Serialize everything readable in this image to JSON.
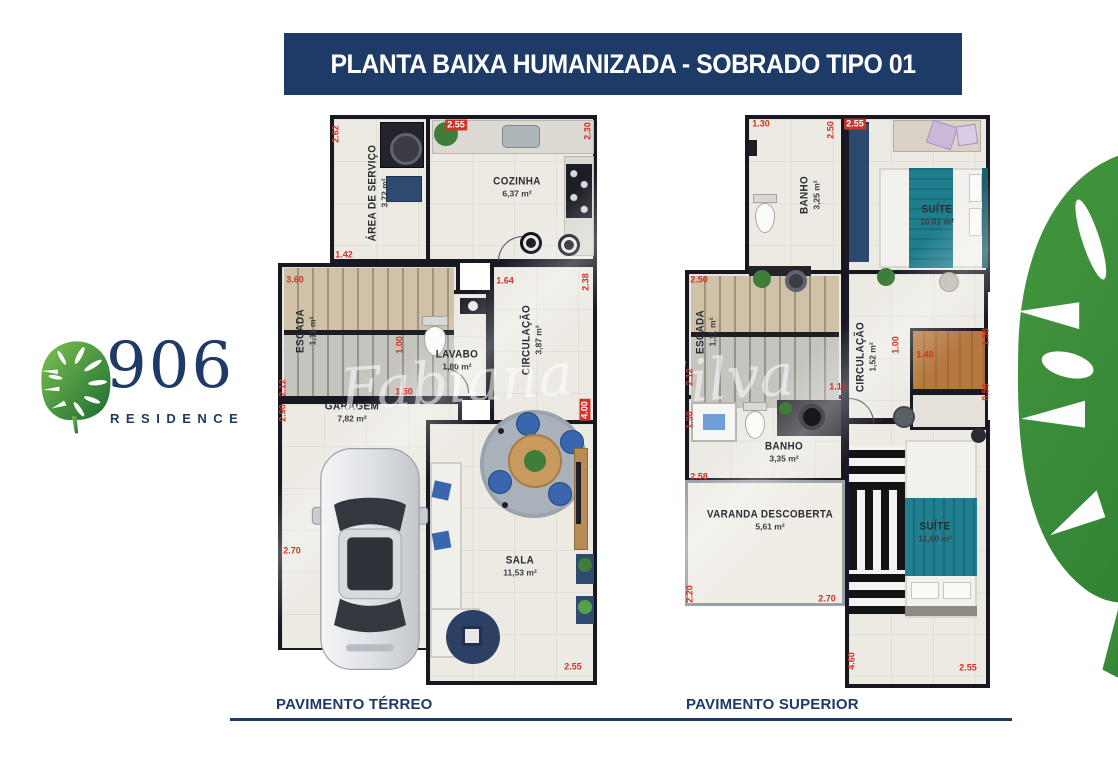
{
  "title": "PLANTA BAIXA HUMANIZADA - SOBRADO TIPO 01",
  "logo": {
    "number": "906",
    "name": "RESIDENCE"
  },
  "watermark": {
    "first": "Fabiana",
    "second": "Silva"
  },
  "colors": {
    "navy": "#1e3a66",
    "dim_red": "#cf3428",
    "wall": "#181823",
    "floor": "#edeae4",
    "leaf_green": "#3e8e3a",
    "teal_bed": "#1f7e8d",
    "chair_blue": "#3a66b0"
  },
  "terreo": {
    "caption": "PAVIMENTO TÉRREO",
    "rooms": [
      {
        "name": "ÁREA DE SERVIÇO",
        "area": "3,72 m²"
      },
      {
        "name": "COZINHA",
        "area": "6,37 m²"
      },
      {
        "name": "ESCADA",
        "area": "1,11 m²"
      },
      {
        "name": "LAVABO",
        "area": "1,80 m²"
      },
      {
        "name": "CIRCULAÇÃO",
        "area": "3,87 m²"
      },
      {
        "name": "GARAGEM",
        "area": "7,82 m²"
      },
      {
        "name": "SALA",
        "area": "11,53 m²"
      }
    ],
    "dims": [
      "2.62",
      "1.42",
      "2.55",
      "2.30",
      "3.60",
      "1.64",
      "2.38",
      "1.00",
      "1.50",
      "2.12",
      "2.90",
      "4.00",
      "2.70",
      "2.55"
    ]
  },
  "superior": {
    "caption": "PAVIMENTO SUPERIOR",
    "rooms": [
      {
        "name": "BANHO",
        "area": "3,25 m²"
      },
      {
        "name": "SUÍTE",
        "area": "10,01 m²"
      },
      {
        "name": "ESCADA",
        "area": "1,11 m²"
      },
      {
        "name": "CIRCULAÇÃO",
        "area": "1,52 m²"
      },
      {
        "name": "BANHO",
        "area": "3,35 m²"
      },
      {
        "name": "VARANDA DESCOBERTA",
        "area": "5,61 m²"
      },
      {
        "name": "SUÍTE",
        "area": "11,60 m²"
      }
    ],
    "dims": [
      "1.30",
      "2.50",
      "2.55",
      "2.50",
      "1.00",
      "1.40",
      "1.58",
      "0.56",
      "2.12",
      "1.12",
      "1.30",
      "2.58",
      "2.20",
      "2.70",
      "4.60",
      "2.55"
    ]
  }
}
